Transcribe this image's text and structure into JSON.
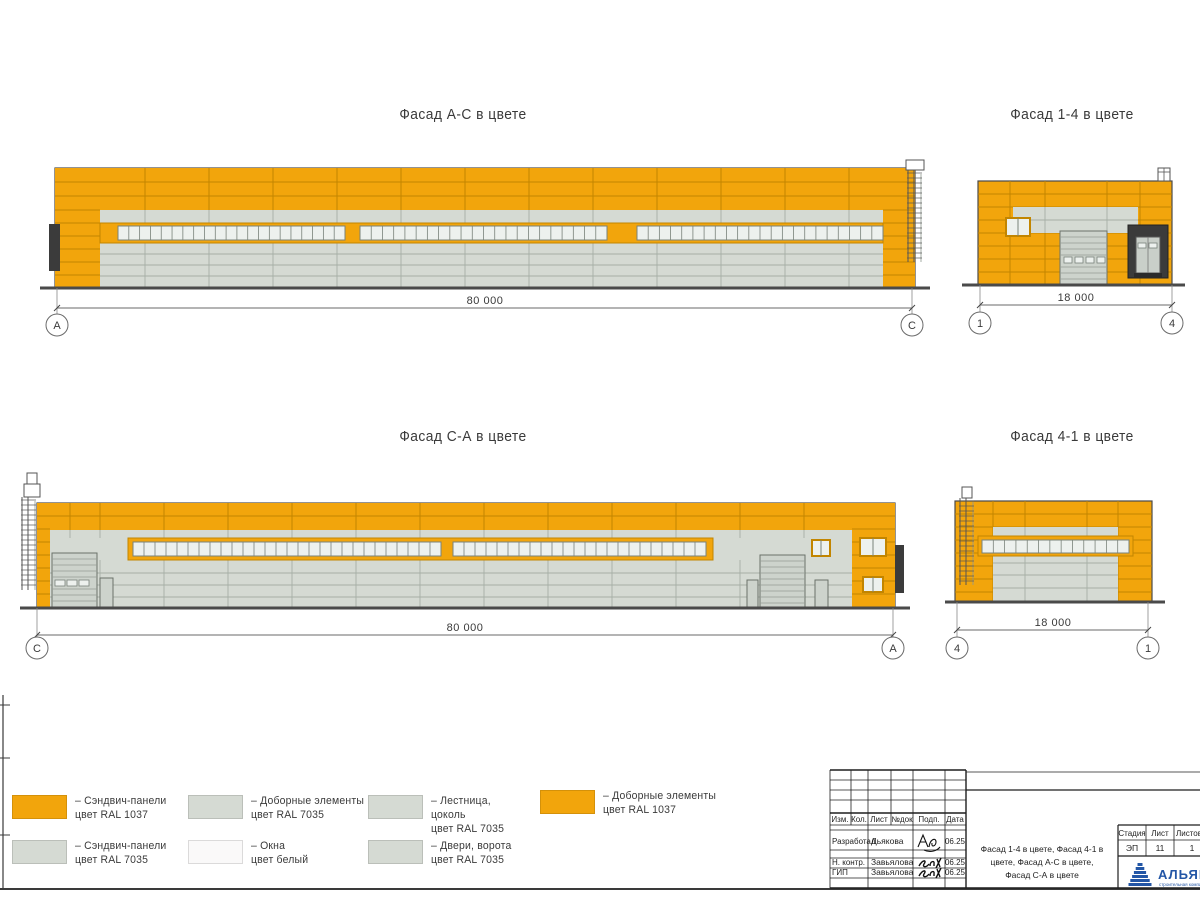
{
  "colors": {
    "ral1037": "#F2A50C",
    "ral1037_joint": "#C28500",
    "ral7035": "#D5DAD3",
    "panel_joint": "#A6AFA6",
    "window": "#EDF1EE",
    "white": "#FAF9F9",
    "dark": "#3B3B3B",
    "outline": "#4A4A4A",
    "logo_blue": "#2356A6"
  },
  "facades": {
    "ac": {
      "title": "Фасад А-С в цвете",
      "dim": "80 000",
      "marker_left": "А",
      "marker_right": "С"
    },
    "f14": {
      "title": "Фасад 1-4 в цвете",
      "dim": "18 000",
      "marker_left": "1",
      "marker_right": "4"
    },
    "ca": {
      "title": "Фасад С-А в цвете",
      "dim": "80 000",
      "marker_left": "С",
      "marker_right": "А"
    },
    "f41": {
      "title": "Фасад 4-1 в цвете",
      "dim": "18 000",
      "marker_left": "4",
      "marker_right": "1"
    }
  },
  "legend": {
    "items": [
      {
        "swatch": "ral1037",
        "lines": [
          "– Сэндвич-панели",
          "цвет RAL 1037"
        ]
      },
      {
        "swatch": "ral7035",
        "lines": [
          "– Сэндвич-панели",
          "цвет RAL 7035"
        ]
      },
      {
        "swatch": "ral7035",
        "lines": [
          "– Доборные элементы",
          "цвет RAL 7035"
        ]
      },
      {
        "swatch": "white",
        "lines": [
          "– Окна",
          "цвет белый"
        ]
      },
      {
        "swatch": "ral7035",
        "lines": [
          "– Лестница,",
          "цоколь",
          "цвет RAL 7035"
        ]
      },
      {
        "swatch": "ral7035",
        "lines": [
          "– Двери, ворота",
          "цвет RAL 7035"
        ]
      },
      {
        "swatch": "ral1037",
        "lines": [
          "– Доборные элементы",
          "цвет RAL 1037"
        ]
      }
    ]
  },
  "titleblock": {
    "header": [
      "Изм.",
      "Кол.",
      "Лист",
      "№док",
      "Подп.",
      "Дата"
    ],
    "rows": [
      {
        "role": "Разработал",
        "name": "Дьякова",
        "date": "06.25"
      },
      {
        "role": "Н. контр.",
        "name": "Завьялова",
        "date": "06.25"
      },
      {
        "role": "ГИП",
        "name": "Завьялова",
        "date": "06.25"
      }
    ],
    "doc_title_lines": [
      "Фасад 1-4 в цвете, Фасад 4-1 в",
      "цвете, Фасад А-С в цвете,",
      "Фасад С-А в цвете"
    ],
    "stage_label": "Стадия",
    "stage_value": "ЭП",
    "sheet_label": "Лист",
    "sheet_value": "11",
    "sheets_label": "Листов",
    "sheets_value": "1",
    "logo_text": "АЛЬЯНС",
    "logo_subtext": "строительная компания"
  }
}
